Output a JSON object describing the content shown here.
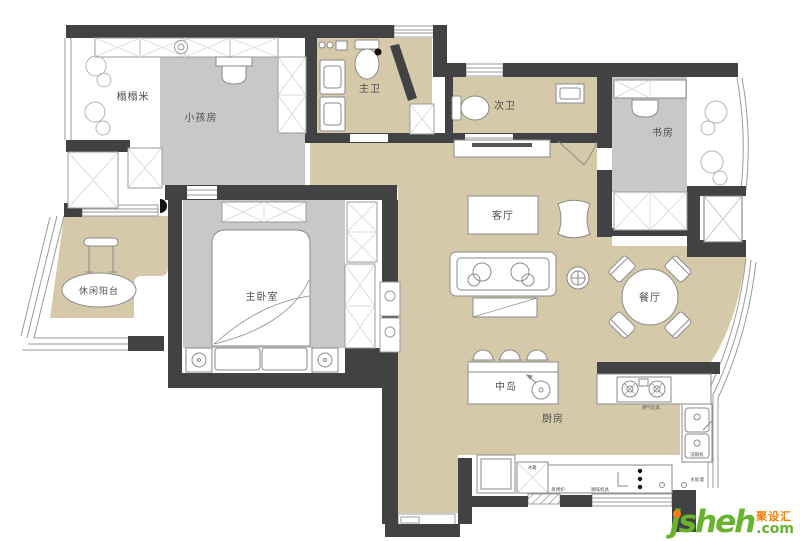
{
  "colors": {
    "wall": "#424244",
    "room_gray": "#c8c8ca",
    "floor_tan": "#d6c9a9",
    "furniture_stroke": "#8a8a8a",
    "closet_x": "#cccccc",
    "logo_green": "#68b42e",
    "logo_orange": "#f87f0a"
  },
  "rooms": {
    "tatami": "榻榻米",
    "kids": "小孩房",
    "master_bath": "主卫",
    "second_bath": "次卫",
    "study": "书房",
    "living": "客厅",
    "balcony": "休闲阳台",
    "master_bedroom": "主卧室",
    "dining": "餐厅",
    "island": "中岛",
    "kitchen": "厨房"
  },
  "appliances": {
    "fridge": "冰箱",
    "steam_oven": "蒸烤炉",
    "coffee_machine": "咖啡机具",
    "gas_stove": "燃气灶具",
    "dishwasher": "洗碗机",
    "water_unit": "水处理"
  },
  "logo": {
    "brand": "jsheh",
    "cn": "聚设汇",
    "tld": ".com"
  }
}
